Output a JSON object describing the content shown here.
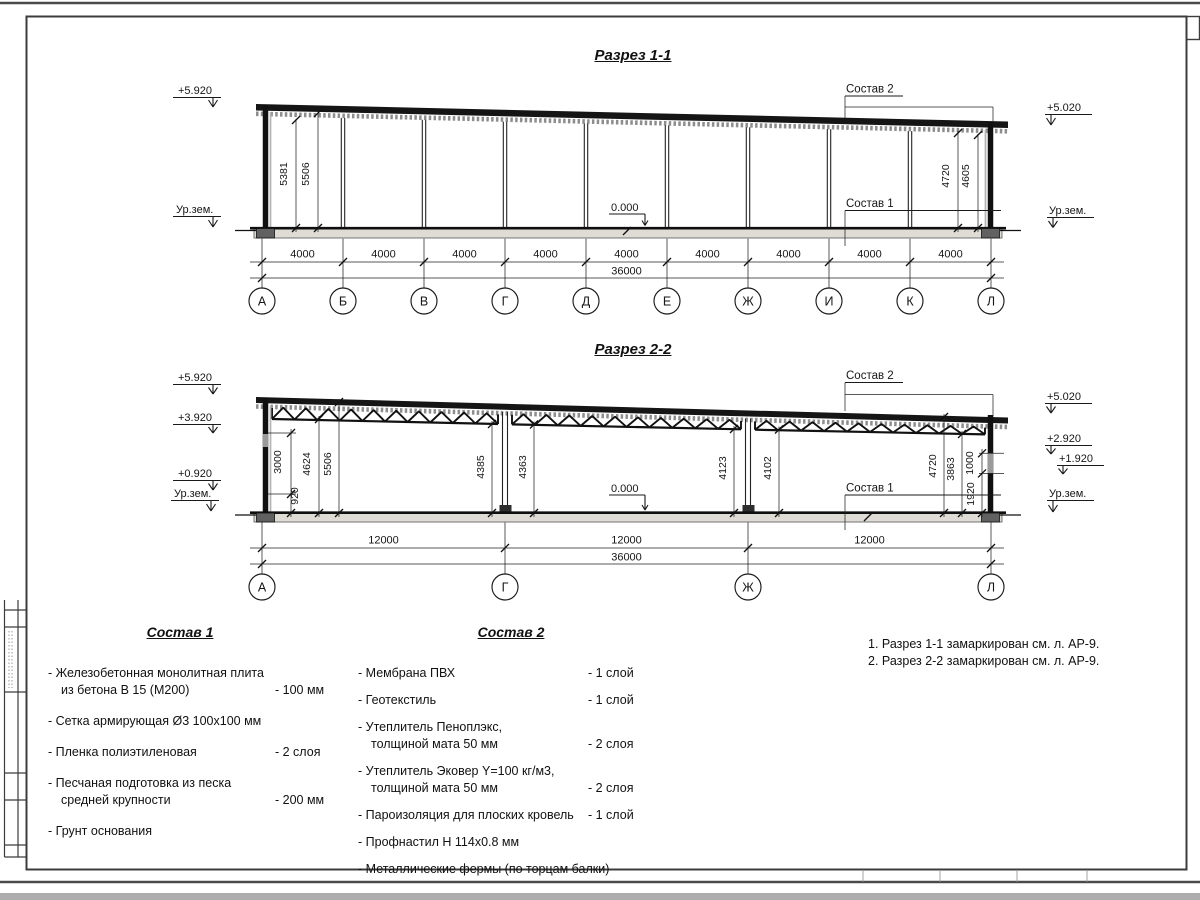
{
  "s1": {
    "title": "Разрез 1-1",
    "elev_top_left": "+5.920",
    "elev_ground_left": "Ур.зем.",
    "elev_top_right": "+5.020",
    "elev_ground_right": "Ур.зем.",
    "zero": "0.000",
    "comp2_label": "Состав 2",
    "comp1_label": "Состав 1",
    "h": [
      "5381",
      "5506",
      "4720",
      "4605"
    ],
    "bays": [
      "4000",
      "4000",
      "4000",
      "4000",
      "4000",
      "4000",
      "4000",
      "4000",
      "4000"
    ],
    "total": "36000",
    "axes": [
      "А",
      "Б",
      "В",
      "Г",
      "Д",
      "Е",
      "Ж",
      "И",
      "К",
      "Л"
    ]
  },
  "s2": {
    "title": "Разрез 2-2",
    "elevL": [
      "+5.920",
      "+3.920",
      "+0.920",
      "Ур.зем."
    ],
    "elevR": [
      "+5.020",
      "+2.920",
      "+1.920",
      "Ур.зем."
    ],
    "zero": "0.000",
    "comp2_label": "Состав 2",
    "comp1_label": "Состав 1",
    "hL": [
      "3000",
      "920",
      "4624",
      "5506"
    ],
    "hM": [
      "4385",
      "4363",
      "4123",
      "4102"
    ],
    "hR": [
      "4720",
      "3863",
      "1000",
      "1920"
    ],
    "bays": [
      "12000",
      "12000",
      "12000"
    ],
    "total": "36000",
    "axes": [
      "А",
      "Г",
      "Ж",
      "Л"
    ]
  },
  "comp1": {
    "title": "Состав 1",
    "items": [
      {
        "l1": "- Железобетонная  монолитная плита",
        "l2": "из бетона В 15 (М200)",
        "q": "- 100 мм"
      },
      {
        "l1": "- Сетка армирующая Ø3 100х100 мм",
        "q": ""
      },
      {
        "l1": "- Пленка полиэтиленовая",
        "q": "-  2 слоя"
      },
      {
        "l1": "- Песчаная подготовка из песка",
        "l2": "средней крупности",
        "q": "- 200 мм"
      },
      {
        "l1": "- Грунт основания",
        "q": ""
      }
    ]
  },
  "comp2": {
    "title": "Состав 2",
    "items": [
      {
        "l1": "- Мембрана ПВХ",
        "q": "- 1 слой"
      },
      {
        "l1": "- Геотекстиль",
        "q": "- 1 слой"
      },
      {
        "l1": "- Утеплитель Пеноплэкс,",
        "l2": "толщиной мата 50 мм",
        "q": "- 2 слоя"
      },
      {
        "l1": "- Утеплитель Эковер Y=100 кг/м3,",
        "l2": "толщиной мата 50 мм",
        "q": "- 2 слоя"
      },
      {
        "l1": "- Пароизоляция для плоских кровель",
        "q": "- 1 слой"
      },
      {
        "l1": "- Профнастил Н 114х0.8 мм",
        "q": ""
      },
      {
        "l1": "- Металлические фермы (по торцам балки)",
        "q": ""
      }
    ]
  },
  "notes": [
    "1. Разрез 1-1 замаркирован см. л. АР-9.",
    "2. Разрез 2-2 замаркирован см. л. АР-9."
  ]
}
